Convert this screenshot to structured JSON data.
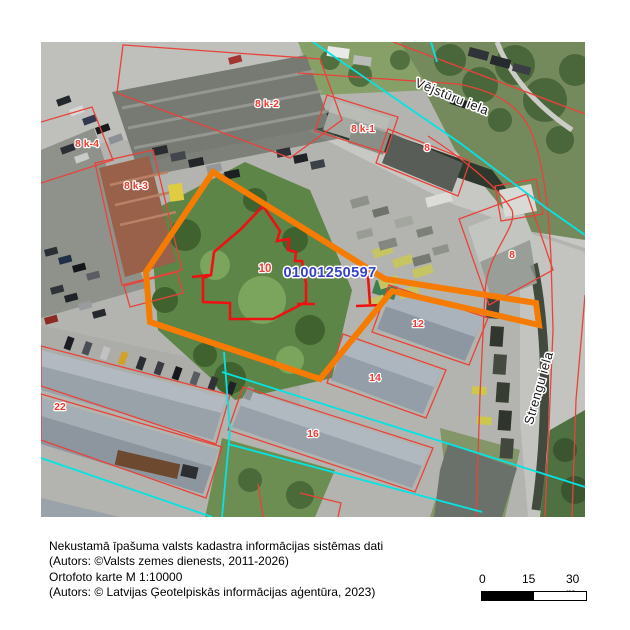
{
  "map": {
    "cadastral_number": "01001250597",
    "street_labels": [
      {
        "text": "Vējstūru iela"
      },
      {
        "text": "Strengu iela"
      }
    ],
    "parcel_labels": [
      {
        "text": "8 k-2"
      },
      {
        "text": "8 k-1"
      },
      {
        "text": "8"
      },
      {
        "text": "8 k-4"
      },
      {
        "text": "8 k-3"
      },
      {
        "text": "10"
      },
      {
        "text": "8"
      },
      {
        "text": "12"
      },
      {
        "text": "14"
      },
      {
        "text": "16"
      },
      {
        "text": "22"
      }
    ],
    "colors": {
      "highlight": "#F57C00",
      "boundary": "#E8433A",
      "parcel_10_boundary": "#EE1111",
      "survey_line": "#06E3E3",
      "cadastral_number_text": "#3740C8",
      "parcel_label_text": "#F03B30"
    }
  },
  "footer": {
    "lines": [
      "Nekustamā īpašuma valsts kadastra informācijas sistēmas dati",
      "(Autors: ©Valsts zemes dienests, 2011-2026)",
      "Ortofoto karte M 1:10000",
      "(Autors: © Latvijas Ģeotelpiskās informācijas aģentūra, 2023)"
    ]
  },
  "scalebar": {
    "ticks": [
      "0",
      "15",
      "30 m"
    ]
  }
}
